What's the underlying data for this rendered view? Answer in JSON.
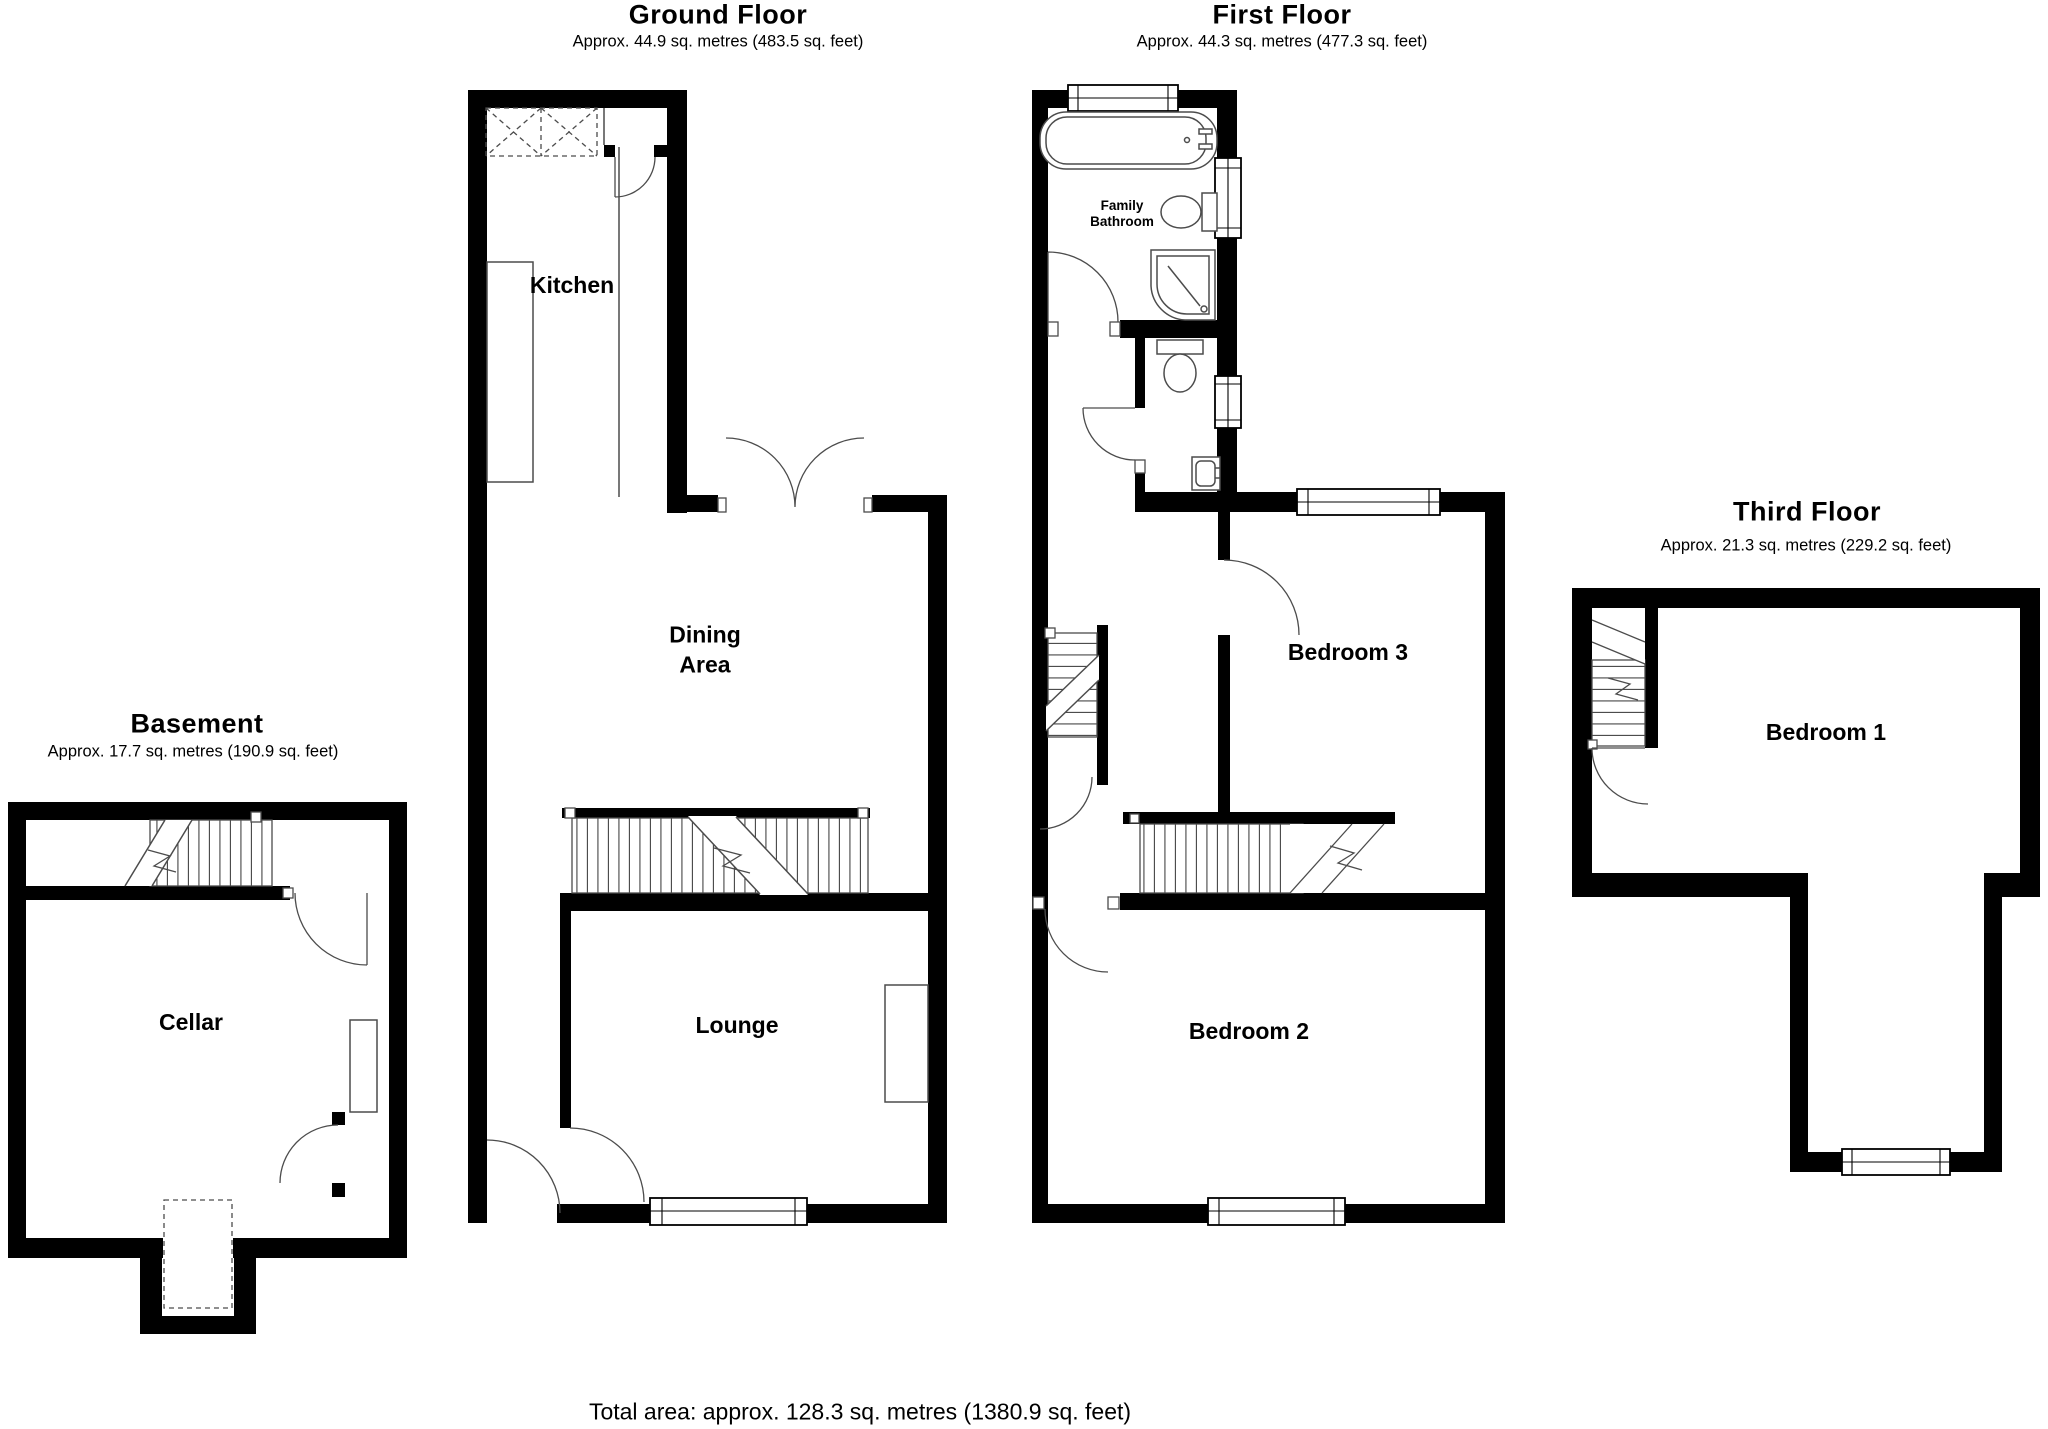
{
  "colors": {
    "background": "#ffffff",
    "wall": "#000000",
    "fixture_line": "#4c4c4c"
  },
  "floors": {
    "ground": {
      "title": "Ground Floor",
      "subtitle": "Approx. 44.9 sq. metres (483.5 sq. feet)",
      "rooms": {
        "kitchen": "Kitchen",
        "dining_line1": "Dining",
        "dining_line2": "Area",
        "lounge": "Lounge"
      }
    },
    "first": {
      "title": "First Floor",
      "subtitle": "Approx. 44.3 sq. metres (477.3 sq. feet)",
      "rooms": {
        "bathroom_line1": "Family",
        "bathroom_line2": "Bathroom",
        "bedroom3": "Bedroom 3",
        "bedroom2": "Bedroom 2"
      }
    },
    "third": {
      "title": "Third Floor",
      "subtitle": "Approx. 21.3 sq. metres (229.2 sq. feet)",
      "rooms": {
        "bedroom1": "Bedroom 1"
      }
    },
    "basement": {
      "title": "Basement",
      "subtitle": "Approx. 17.7 sq. metres (190.9 sq. feet)",
      "rooms": {
        "cellar": "Cellar"
      }
    }
  },
  "footer": {
    "total_area": "Total area: approx. 128.3 sq. metres (1380.9 sq. feet)"
  }
}
